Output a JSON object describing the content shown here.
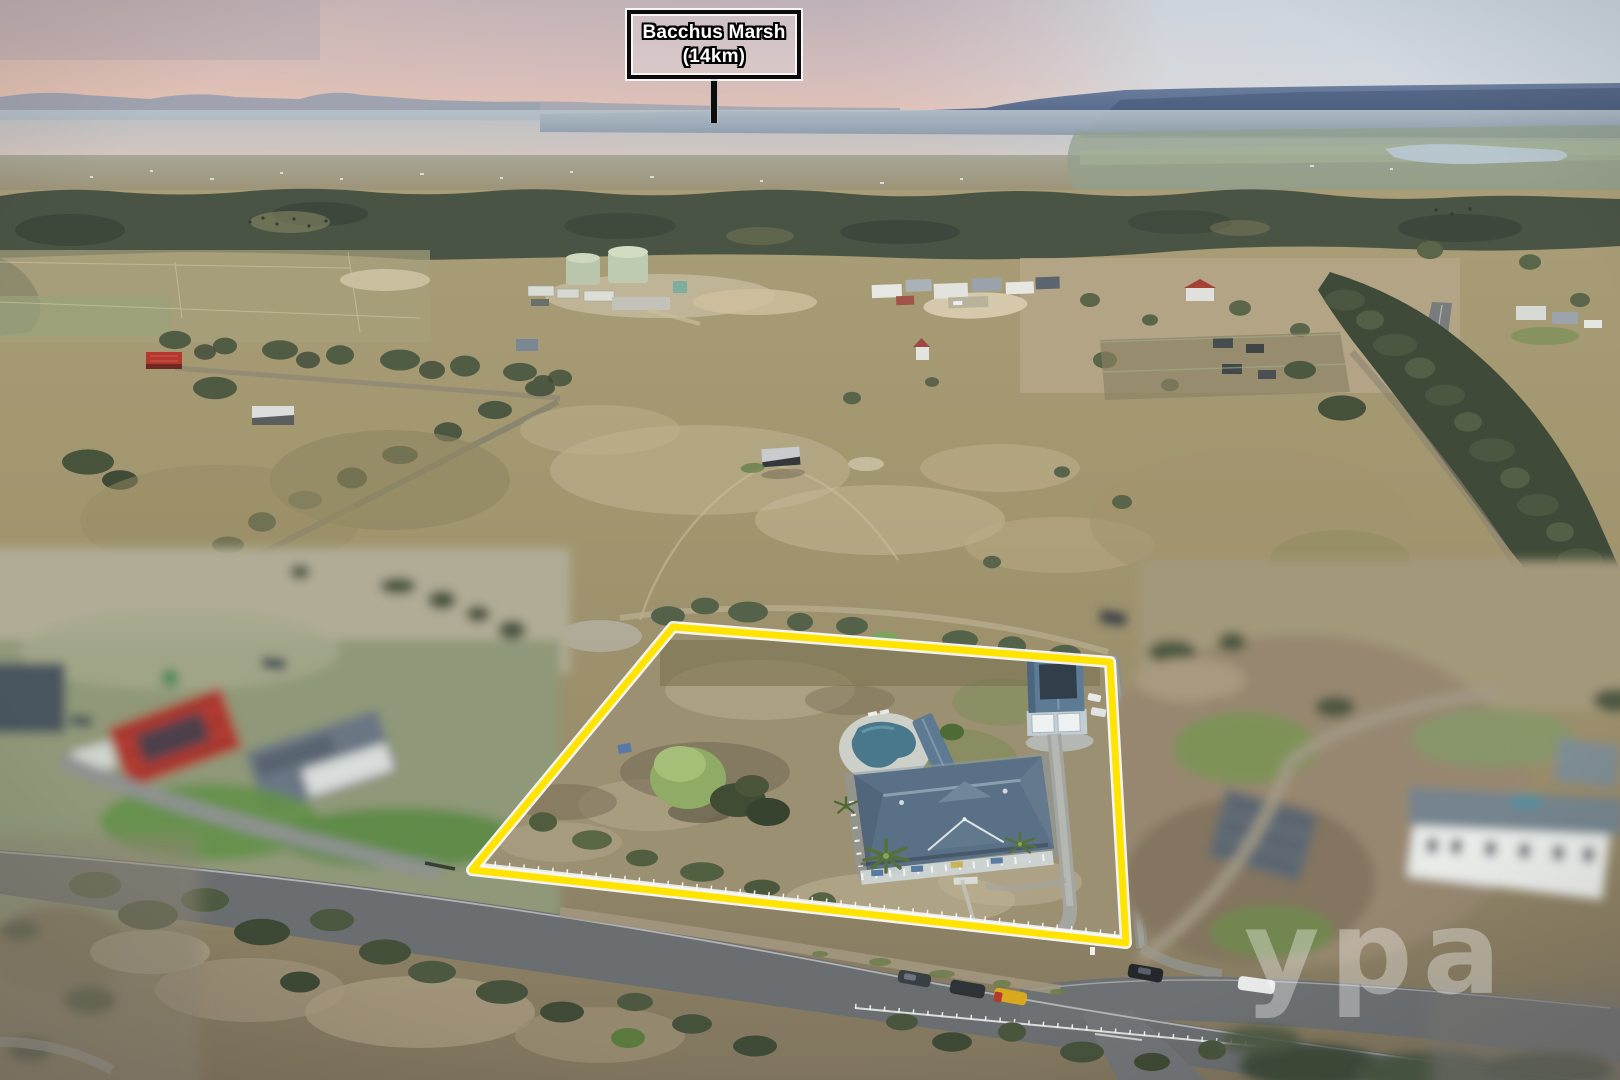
{
  "scene": {
    "type": "aerial-property-photograph",
    "time_of_day": "dusk",
    "sign": {
      "line1": "Bacchus Marsh",
      "line2": "(14km)"
    },
    "watermark": "ypa",
    "property": {
      "boundary_points": "673,627 1110,662 1126,943 472,870",
      "features": [
        "homestead with blue hip roof and wraparound veranda",
        "double garage shed with solar panel",
        "swimming pool with pavilion",
        "palm trees",
        "white picket road-front fence",
        "dry grass paddock with gum trees"
      ]
    }
  },
  "palette": {
    "boundary_yellow": "#ffe400",
    "boundary_halo": "#ffffff",
    "sky_pink": "#e5c2b2",
    "sky_blue": "#d7e2e8",
    "hills_blue": "#5d7292",
    "forest_green": "#4a5444",
    "field_tan": "#a89c76",
    "dry_grass": "#9b9072",
    "roof_blue": "#5b7086",
    "road_grey": "#6b6e70",
    "fence_white": "#eef0ee"
  }
}
